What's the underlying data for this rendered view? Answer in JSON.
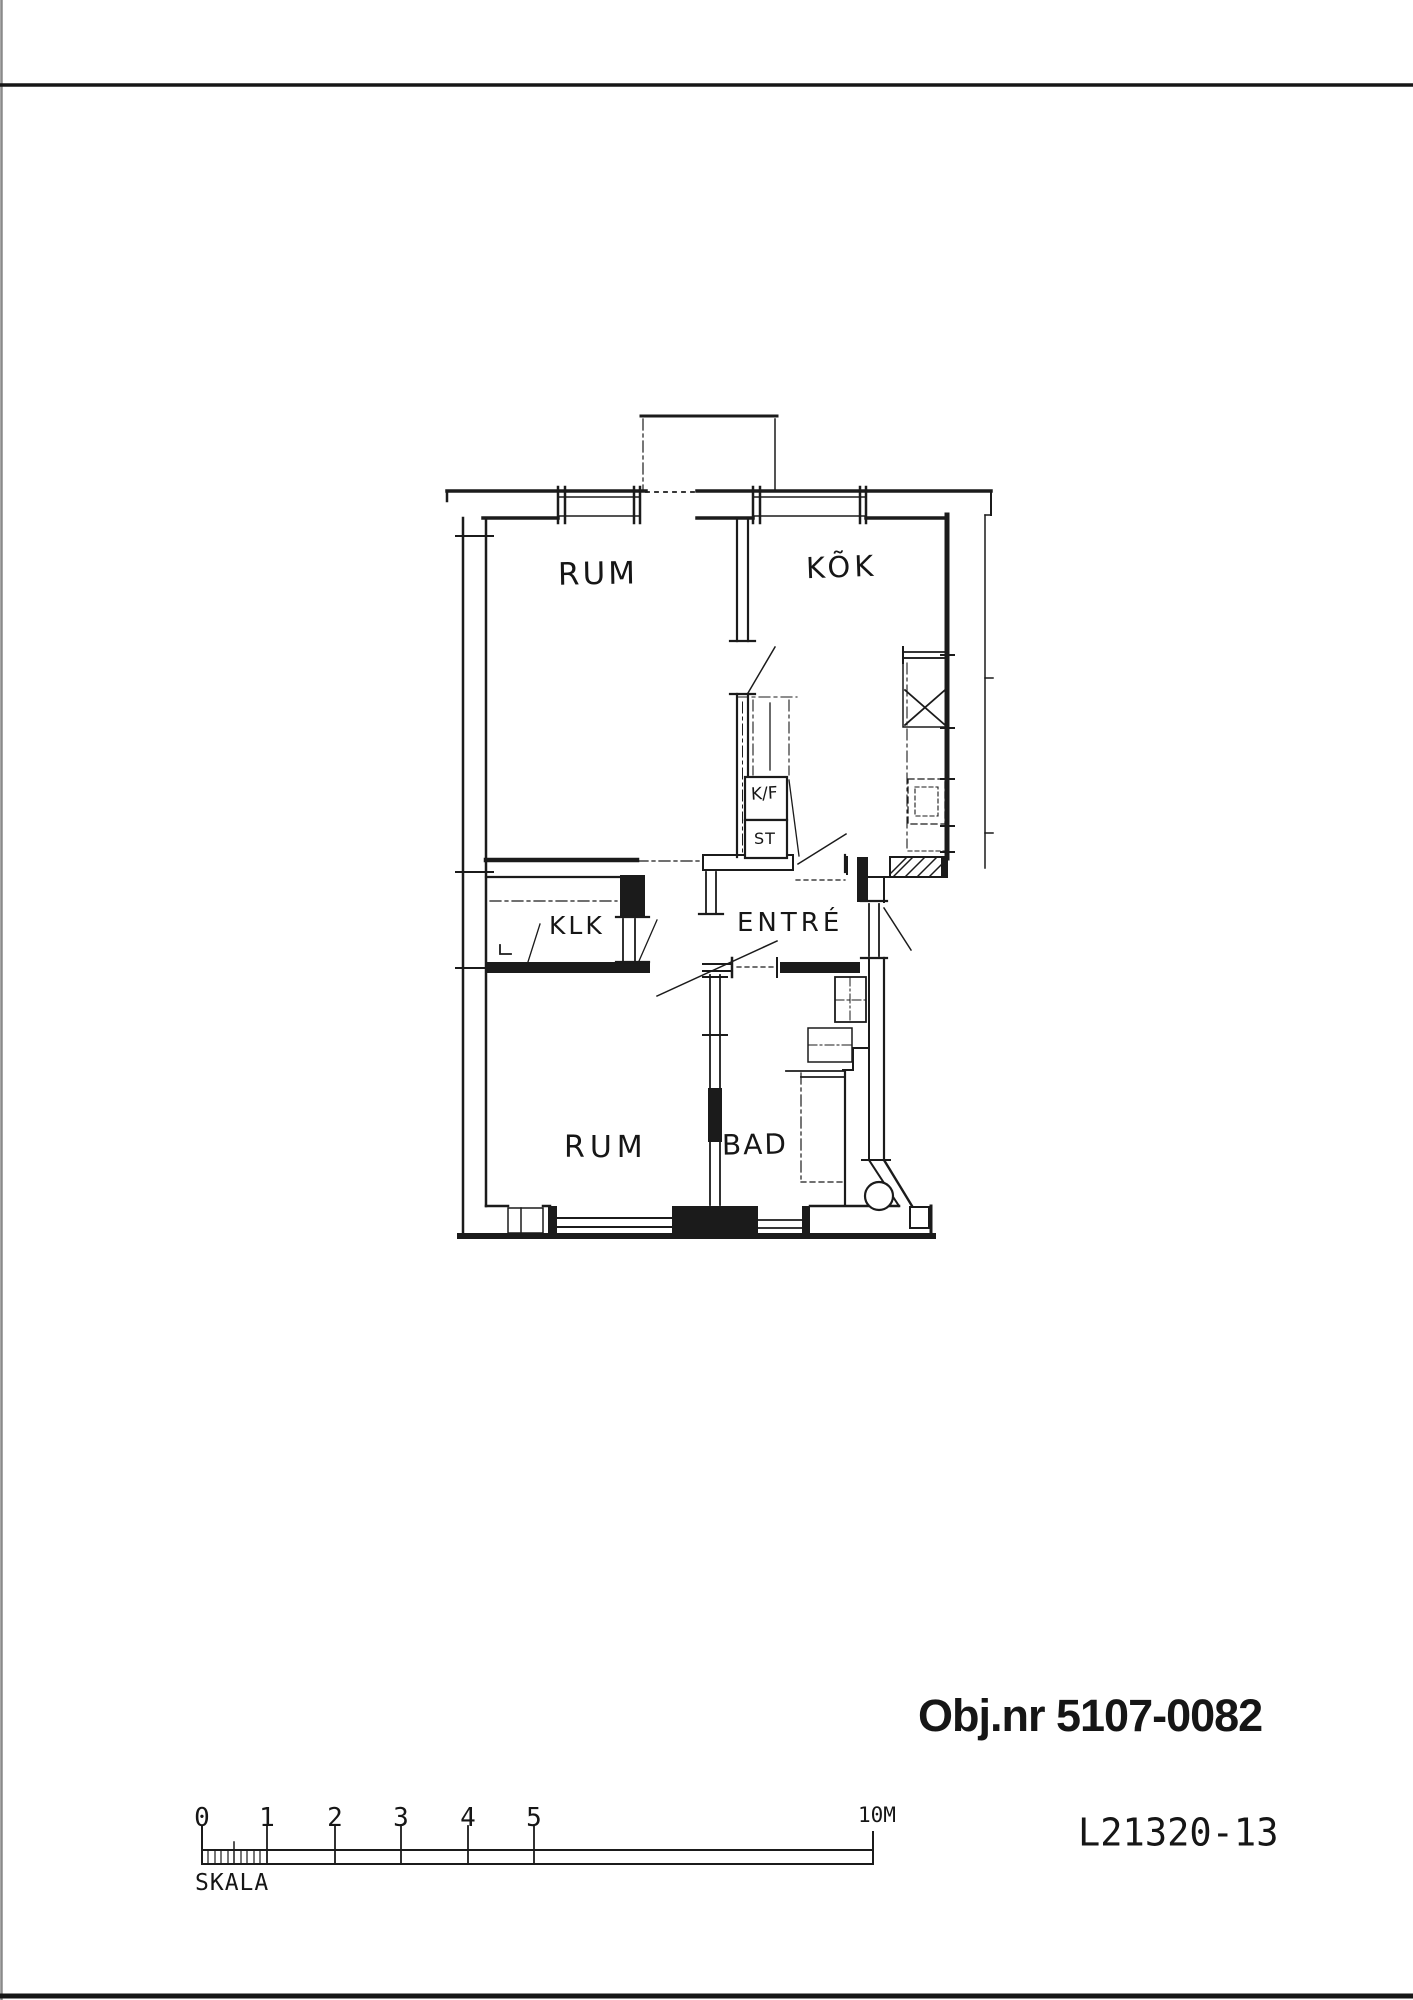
{
  "floor_plan": {
    "rooms": {
      "room_upper": "RUM",
      "kitchen": "KÕK",
      "closet": "KLK",
      "entry": "ENTRÉ",
      "room_lower": "RUM",
      "bath": "BAD"
    },
    "fixtures": {
      "fridge_freezer": "K/F",
      "storage": "ST"
    }
  },
  "annotations": {
    "object_number": "Obj.nr 5107-0082",
    "drawing_number": "L21320-13"
  },
  "scale_bar": {
    "label": "SKALA",
    "ticks": [
      "0",
      "1",
      "2",
      "3",
      "4",
      "5"
    ],
    "end_label": "10M"
  },
  "colors": {
    "ink": "#1b1b1b",
    "paper": "#ffffff",
    "border_gray": "#8a8a8a"
  }
}
